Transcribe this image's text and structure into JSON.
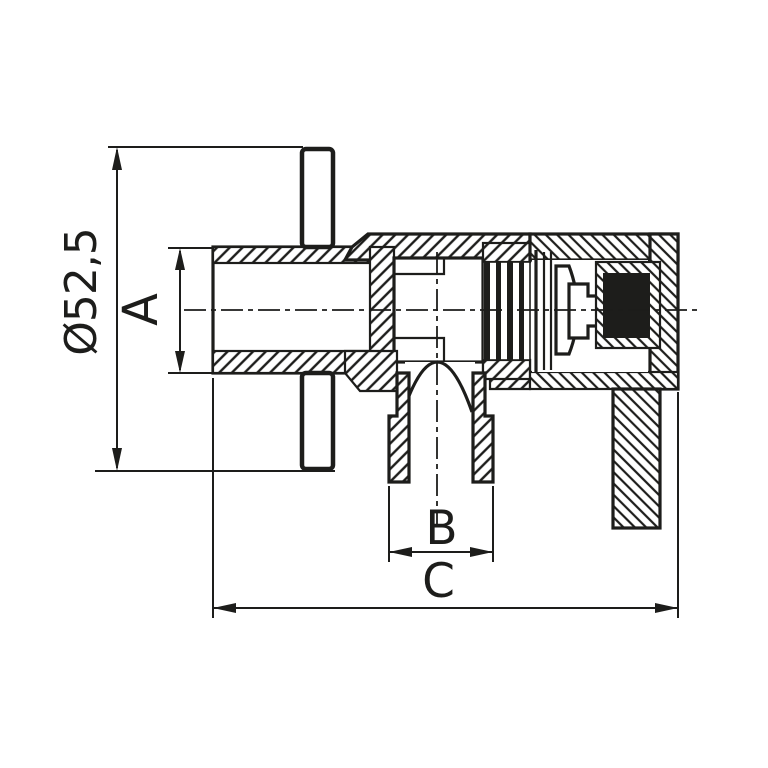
{
  "drawing": {
    "title": "angle-valve-cross-section",
    "dimensions": {
      "diameter": {
        "label": "Ø52,5",
        "orientation": "vertical",
        "measures": "rosette-flange-diameter"
      },
      "a": {
        "label": "A",
        "orientation": "vertical",
        "measures": "inlet-thread-outer-diameter"
      },
      "b": {
        "label": "B",
        "orientation": "horizontal",
        "measures": "outlet-connector-width"
      },
      "c": {
        "label": "C",
        "orientation": "horizontal",
        "measures": "overall-length"
      }
    },
    "colors": {
      "ink": "#1d1d1b",
      "background": "#ffffff",
      "seal_fill": "#1d1d1b"
    }
  }
}
